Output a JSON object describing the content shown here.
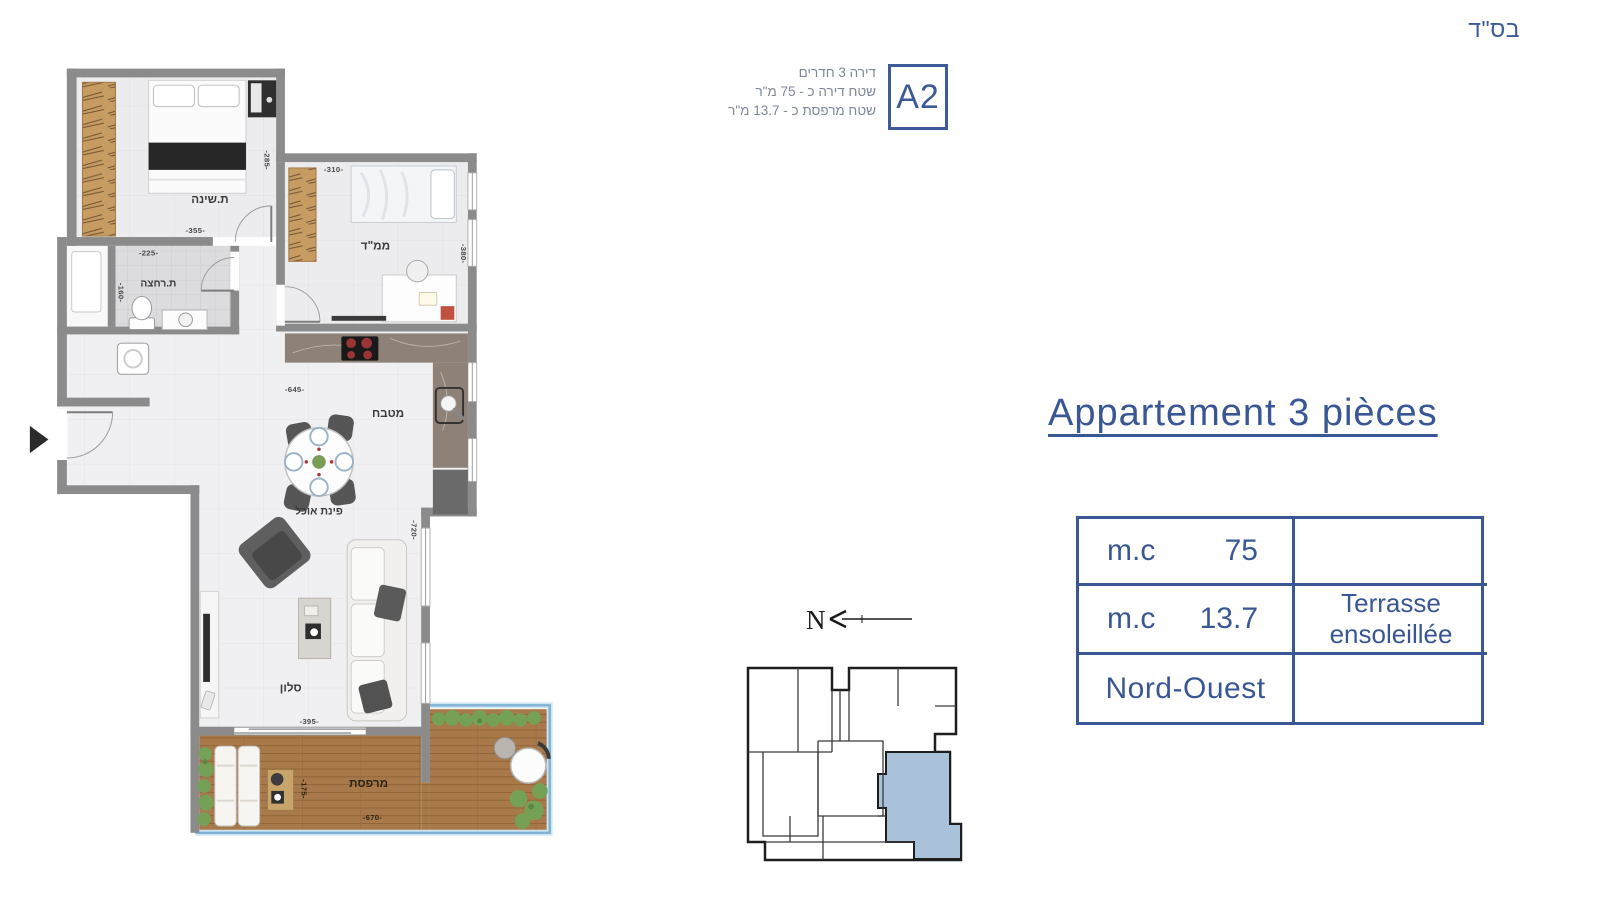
{
  "meta": {
    "bsd": "בס\"ד"
  },
  "header": {
    "line1": "דירה 3 חדרים",
    "line2": "שטח דירה כ - 75 מ\"ר",
    "line3": "שטח מרפסת כ - 13.7 מ\"ר",
    "unit_code": "A2"
  },
  "title": "Appartement 3 pièces",
  "info_table": {
    "rows": [
      {
        "label": "m.c",
        "value": "75",
        "note": ""
      },
      {
        "label": "m.c",
        "value": "13.7",
        "note_line1": "Terrasse",
        "note_line2": "ensoleillée"
      },
      {
        "label": "Nord-Ouest",
        "value": "",
        "note": ""
      }
    ]
  },
  "floor_plan": {
    "rooms": {
      "bedroom": "ת.שינה",
      "safe_room": "ממ\"ד",
      "bathroom": "ת.רחצה",
      "kitchen": "מטבח",
      "dining": "פינת אוכל",
      "living": "סלון",
      "terrace": "מרפסת"
    },
    "dims": {
      "bedroom_w": "-355-",
      "bedroom_h": "-285-",
      "bath_w": "-225-",
      "bath_h": "-160-",
      "safe_room_w": "-310-",
      "safe_room_h": "-380-",
      "open_space_w": "-645-",
      "living_h": "-720-",
      "living_w": "-395-",
      "terrace_w": "-670-",
      "terrace_h": "-175-"
    }
  },
  "compass": {
    "north_label": "N"
  },
  "colors": {
    "accent": "#3a5795",
    "header_text": "#7e8798",
    "wall": "#8b8b8b",
    "wood": "#c79c63",
    "deck": "#a87a4b",
    "plant": "#74a155",
    "railing": "#7fb2d4",
    "highlighted_unit": "#a9c2d9"
  }
}
